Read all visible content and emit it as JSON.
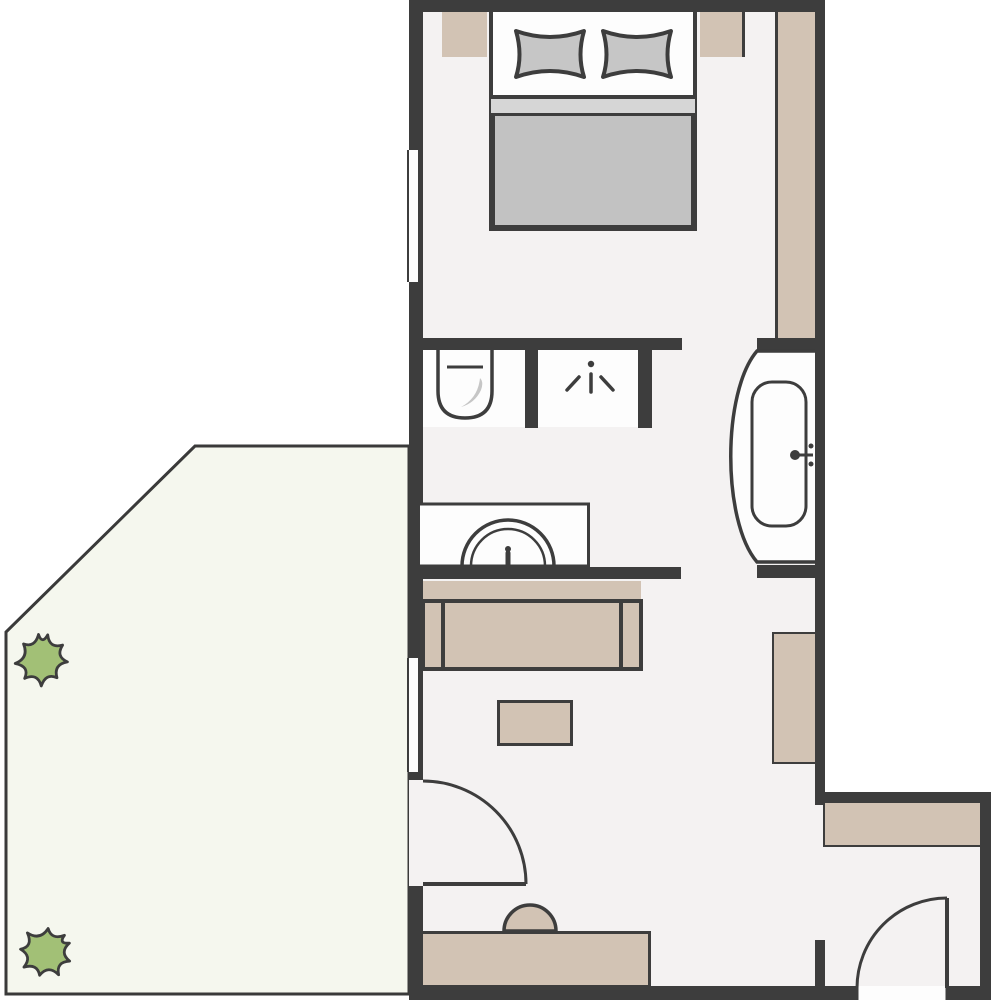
{
  "diagram": {
    "kind": "apartment-floor-plan",
    "rooms": [
      "bedroom",
      "bathroom",
      "living-area",
      "entrance-hall",
      "terrace"
    ],
    "furniture": [
      "double-bed",
      "left-pillow",
      "right-pillow",
      "left-nightstand",
      "right-nightstand",
      "wardrobe",
      "sofa",
      "coffee-table",
      "tv-board",
      "sideboard",
      "bottom-counter",
      "stool"
    ],
    "fixtures": [
      "toilet",
      "shower",
      "washbasin-vanity",
      "bathtub"
    ],
    "openings": [
      "bedroom-window",
      "living-room-window",
      "terrace-door",
      "entrance-door",
      "bedroom-passage",
      "living-passage",
      "hall-passage"
    ],
    "plant_count": 2
  },
  "palette": {
    "wall": "#3d3d3d",
    "floor": "#f4f2f2",
    "furniture_beige": "#d2c3b4",
    "terrace_green_white": "#f5f7ee",
    "plant_green": "#a2c076",
    "fixture_white": "#fdfdfd",
    "pillow_gray": "#c6c6c6",
    "blanket_gray": "#c2c2c2",
    "sheet_gray": "#d6d6d6",
    "outside": "#ffffff"
  }
}
